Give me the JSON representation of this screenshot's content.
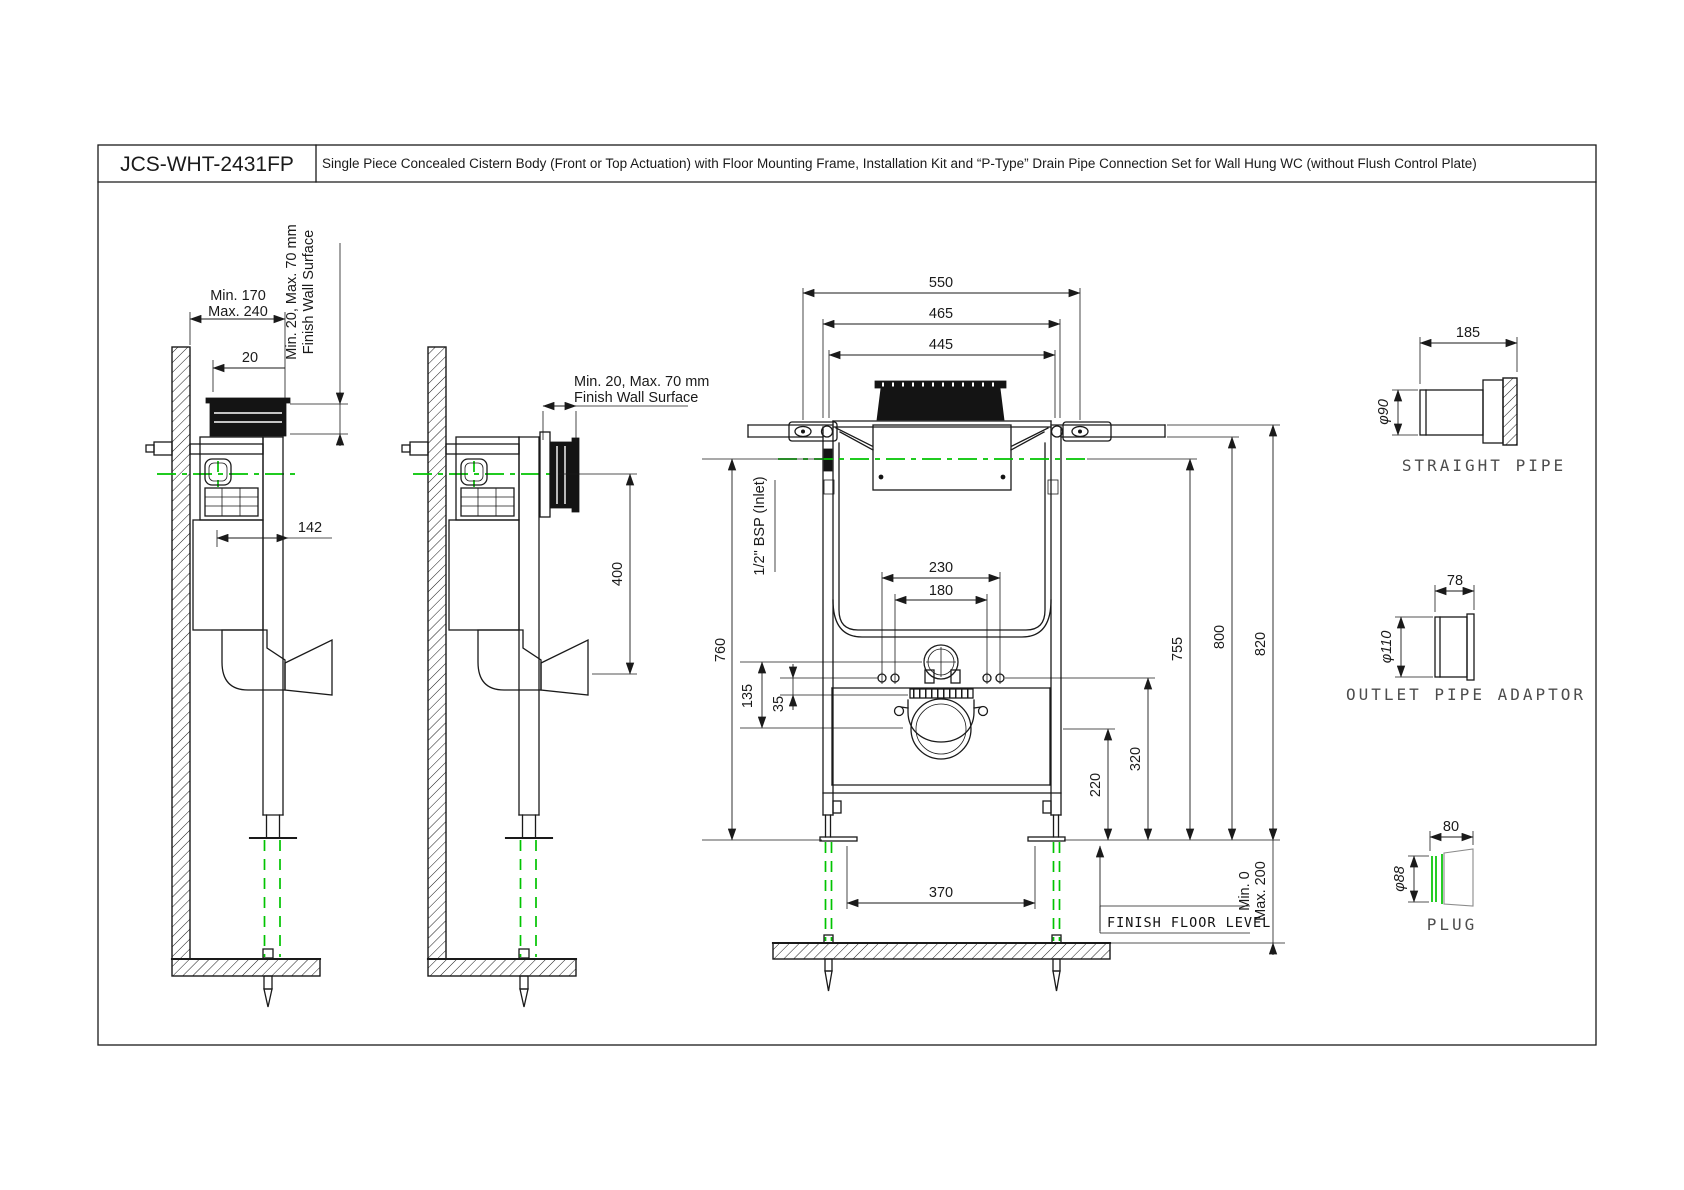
{
  "title_block": {
    "model": "JCS-WHT-2431FP",
    "description": "Single Piece Concealed Cistern Body (Front or Top Actuation) with Floor Mounting Frame, Installation Kit and “P-Type” Drain Pipe Connection Set for Wall Hung WC (without Flush Control Plate)"
  },
  "side_view_top_actuation": {
    "depth_min": "Min. 170",
    "depth_max": "Max. 240",
    "offset_20": "20",
    "width_142": "142",
    "wall_note_1": "Min. 20, Max. 70 mm",
    "wall_note_2": "Finish Wall Surface"
  },
  "side_view_front_actuation": {
    "wall_note_1": "Min. 20, Max. 70 mm",
    "wall_note_2": "Finish Wall Surface",
    "outlet_drop_400": "400"
  },
  "front_view": {
    "width_550": "550",
    "width_465": "465",
    "width_445": "445",
    "inlet_label": "1/2\" BSP (Inlet)",
    "height_760": "760",
    "offset_135": "135",
    "offset_35": "35",
    "bolt_span_230": "230",
    "bolt_span_180": "180",
    "height_755": "755",
    "height_800": "800",
    "height_820": "820",
    "height_320": "320",
    "height_220": "220",
    "leg_span_370": "370",
    "floor_label": "FINISH FLOOR LEVEL",
    "floor_min": "Min. 0",
    "floor_max": "Max. 200"
  },
  "accessories": {
    "straight_pipe": {
      "caption": "STRAIGHT PIPE",
      "length": "185",
      "diameter": "φ90"
    },
    "outlet_pipe_adaptor": {
      "caption": "OUTLET PIPE ADAPTOR",
      "length": "78",
      "diameter": "φ110"
    },
    "plug": {
      "caption": "PLUG",
      "length": "80",
      "diameter": "φ88"
    }
  },
  "colors": {
    "line": "#1a1a1a",
    "accent_green": "#00c400",
    "caption": "#4d4d4d"
  }
}
